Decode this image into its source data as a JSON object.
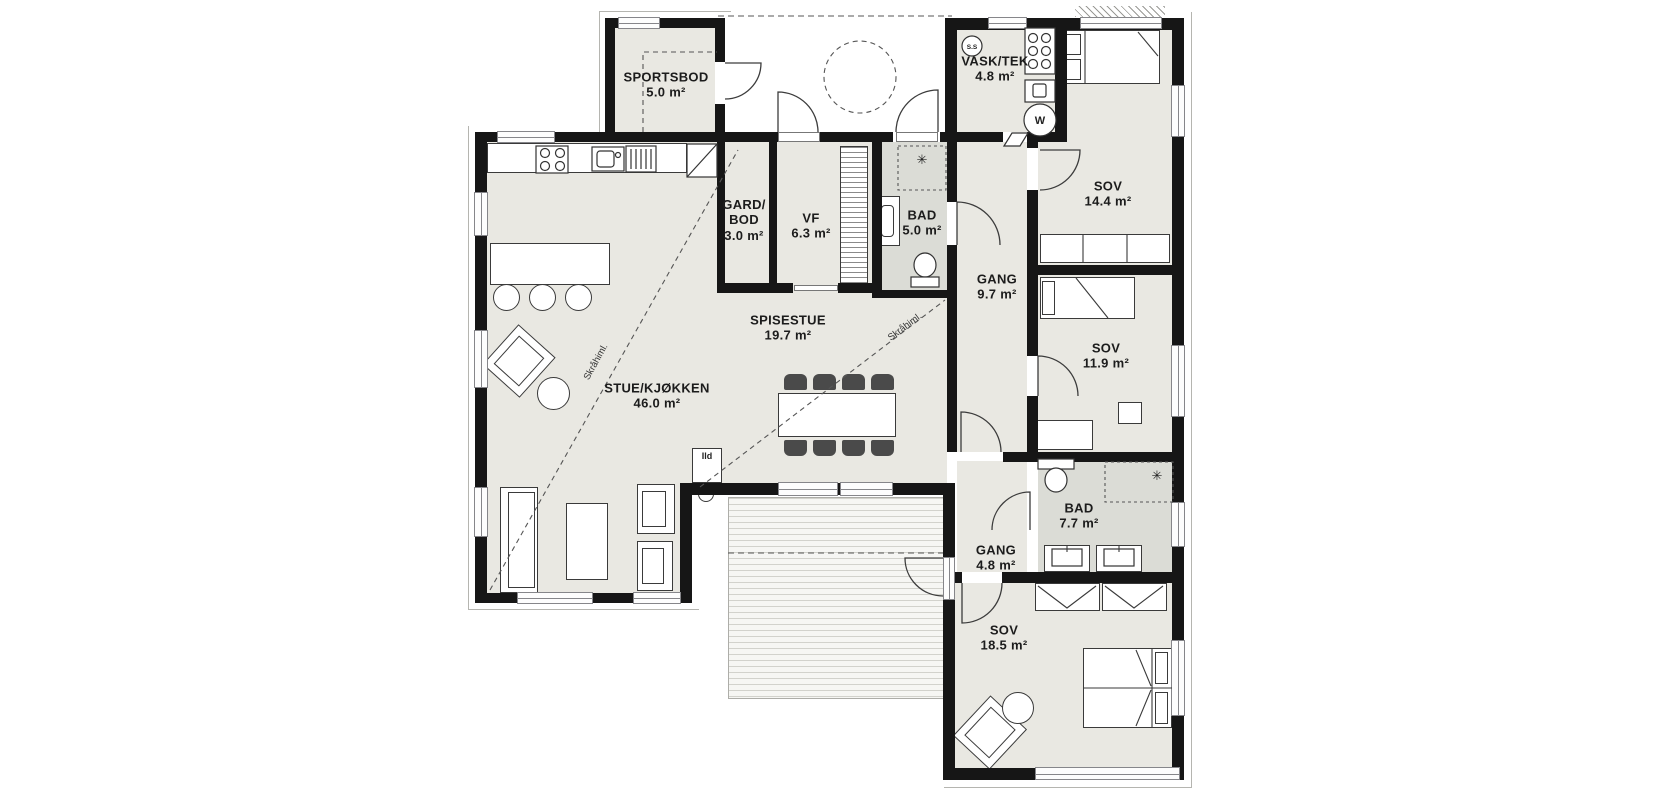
{
  "plan_type": "floor-plan",
  "rooms": [
    {
      "key": "sportsbod",
      "name": "SPORTSBOD",
      "area": "5.0 m²"
    },
    {
      "key": "vask-tek",
      "name": "VASK/TEK",
      "area": "4.8 m²"
    },
    {
      "key": "sov-1",
      "name": "SOV",
      "area": "14.4 m²"
    },
    {
      "key": "gard-bod",
      "name": "GARD/",
      "name2": "BOD",
      "area": "3.0 m²"
    },
    {
      "key": "vf",
      "name": "VF",
      "area": "6.3 m²"
    },
    {
      "key": "bad-1",
      "name": "BAD",
      "area": "5.0 m²"
    },
    {
      "key": "gang-1",
      "name": "GANG",
      "area": "9.7 m²"
    },
    {
      "key": "sov-2",
      "name": "SOV",
      "area": "11.9 m²"
    },
    {
      "key": "spisestue",
      "name": "SPISESTUE",
      "area": "19.7 m²"
    },
    {
      "key": "stue-kjokken",
      "name": "STUE/KJØKKEN",
      "area": "46.0 m²"
    },
    {
      "key": "bad-2",
      "name": "BAD",
      "area": "7.7 m²"
    },
    {
      "key": "gang-2",
      "name": "GANG",
      "area": "4.8 m²"
    },
    {
      "key": "sov-3",
      "name": "SOV",
      "area": "18.5 m²"
    }
  ],
  "annotations": {
    "sloped_ceiling_1": "Skråhiml.",
    "sloped_ceiling_2": "Skråhiml.",
    "fireplace_label": "Ild",
    "fuse_box_label": "S.S",
    "water_heater_label": "W"
  },
  "icons": {
    "shower_glyph": "✳"
  },
  "colors": {
    "wall": "#161616",
    "room_fill": "#e9e8e2",
    "wet_room_fill": "#dbdcd6",
    "deck_line": "#d2d2cc",
    "annotation": "#333333"
  }
}
